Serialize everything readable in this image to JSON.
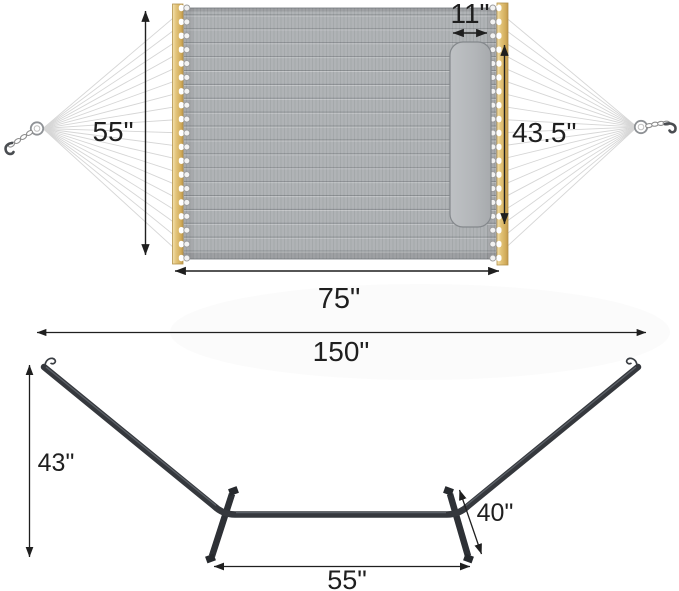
{
  "diagram_title": "Hammock with pillow and stand – dimension diagram",
  "dimensions": {
    "hammock_bed_width": "55\"",
    "pillow_width": "11\"",
    "pillow_length": "43.5\"",
    "hammock_bed_length": "75\"",
    "stand_overall_length": "150\"",
    "stand_height": "43\"",
    "stand_leg_length": "40\"",
    "stand_base_width": "55\""
  },
  "colors": {
    "fabric": "#b0b3b6",
    "pillow": "#b3b6b9",
    "spreader_bar_wood": "#ddbc70",
    "stand_frame": "#35383d",
    "rope": "#d6d6d6",
    "dimension_ink": "#1f1f1f",
    "background": "#ffffff"
  }
}
